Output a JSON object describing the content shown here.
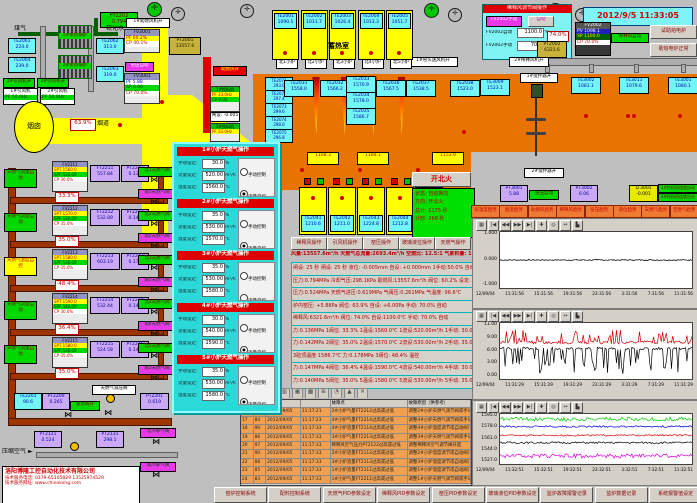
{
  "datetime": "2012/9/5 11:33:05",
  "icons": {
    "fan": "✛",
    "valve": "⋈",
    "arrow_left": "◄",
    "arrow_right": "►"
  },
  "chart_toolbar": [
    "▦",
    "|◀",
    "◀◀",
    "▶▶",
    "▶|",
    "✚",
    "◎",
    "↔",
    "▙"
  ],
  "alarm": {
    "toolbar": [
      "≣",
      "?",
      "▤",
      "▥",
      "▦",
      "▩",
      "⊞",
      "◔",
      "▲",
      "✕"
    ],
    "headers": {
      "point": "故障点",
      "cause": "故障原因（供参考）"
    },
    "rows": [
      [
        "16",
        "98",
        "2012/09/05",
        "11:17:21",
        "2#小炉气量FT2212过高或过低",
        "调整2#小炉天燃气调节阀或手动"
      ],
      [
        "17",
        "84",
        "2012/09/05",
        "11:17:23",
        "4#小炉气量FT2214过高或过低",
        "调整4#小炉天燃气调节阀或手动"
      ],
      [
        "18",
        "90",
        "2012/09/05",
        "11:17:33",
        "4#小炉流量FT2114过高或过低",
        "调整4#小炉温度调节或自动阀门"
      ],
      [
        "19",
        "86",
        "2012/09/05",
        "11:17:33",
        "3#小炉气量FT2213过高或过低",
        "调整3#小炉天燃气调节阀或手动"
      ],
      [
        "20",
        "97",
        "2012/09/05",
        "11:17:33",
        "稀释风空气压力PT2122过高或过低",
        "调整稀释风空气调节阀开度"
      ],
      [
        "21",
        "90",
        "2012/09/05",
        "11:17:33",
        "2#小炉流量FT2112过高或过低",
        "调整2#小炉温度调节或自动阀门"
      ],
      [
        "22",
        "88",
        "2012/09/05",
        "11:17:33",
        "3#小炉流量FT2113过高或过低",
        "调整3#小炉温度调节或自动阀门"
      ],
      [
        "23",
        "85",
        "2012/09/05",
        "11:17:33",
        "1#小炉流量FT2111过高或过低",
        "调整1#小炉温度调节或自动阀门"
      ],
      [
        "24",
        "83",
        "2012/09/05",
        "11:17:33",
        "1#小炉气量FT2211过高或过低",
        "调整1#小炉天燃气调节阀或手动"
      ]
    ]
  },
  "top_left": {
    "ft2202": {
      "tag": "FT2202",
      "value": "0.794"
    },
    "gas_label": "煤气",
    "water_label": "软化水",
    "boiler1": "1#余热锅炉",
    "boiler2": "2#余热锅炉",
    "te2061": {
      "tag": "TE2061",
      "value": "224.0"
    },
    "te2064": {
      "tag": "TE2064",
      "value": "239.0"
    },
    "te2062": {
      "tag": "TE2062",
      "value": "313.0"
    },
    "te2063": {
      "tag": "TE2063",
      "value": "319.0"
    },
    "fan1_on": "1#引风机开",
    "fan2_on": "2#引风机开",
    "fan1": {
      "name": "1#引风机",
      "pf": "PF 50.0Hz"
    },
    "fan2": {
      "name": "2#引风机",
      "pf": "PF 50.0Hz"
    },
    "chimney": "烟囱",
    "duct": "烟道",
    "duct_valve": "63.9%",
    "blower_on": "1#助燃风机开",
    "fv2001": {
      "tag": "FV2001",
      "pf": "PF  60.2%",
      "cp": "CP  40.1%"
    },
    "pt2001": {
      "tag": "PT2001",
      "value": "13557.6"
    },
    "kiln_auto": "窑压自动",
    "fv3001": {
      "tag": "FV3001",
      "pf": "PF  5.88",
      "sp": "SP  6.00",
      "cp": "CP 70.0%"
    },
    "comb_air_on": "助燃风开",
    "feeder1": {
      "title": "1#投料机",
      "pf": "PF 33.0Hz",
      "cp": "CP  0.00"
    },
    "feeder2": {
      "title": "2#投料机",
      "pf": "PF 33.0Hz"
    },
    "gate_set": "闸设: -0.005"
  },
  "north": {
    "fan_on": "1#窑头送风机开",
    "regen_label": "蓄热室",
    "boxes": [
      {
        "tag": "TE2001",
        "value": "1090.1"
      },
      {
        "tag": "TE2002",
        "value": "1011.7"
      },
      {
        "tag": "TE2003",
        "value": "1026.4"
      },
      {
        "tag": "TE2004",
        "value": "1013.3"
      },
      {
        "tag": "TE2005",
        "value": "1051.7"
      }
    ],
    "ports": [
      "北1小炉",
      "北2小炉",
      "北3小炉",
      "北4小炉",
      "北5小炉"
    ]
  },
  "furnace": {
    "left_col": [
      {
        "tag": "TE2071",
        "value": "293.0"
      },
      {
        "tag": "TE2072",
        "value": "297.4"
      },
      {
        "tag": "TE2073",
        "value": "299.6"
      },
      {
        "tag": "TE2074",
        "value": "298.6"
      },
      {
        "tag": "TE2075",
        "value": "296.8"
      }
    ],
    "crown": [
      {
        "tag": "TE2031",
        "value": "1558.0"
      },
      {
        "tag": "TE2032",
        "value": "1566.2"
      },
      {
        "tag": "TE2033",
        "value": "1570.9"
      },
      {
        "tag": "TE2034",
        "value": "1578.0"
      },
      {
        "tag": "TE2035",
        "value": "1586.7"
      },
      {
        "tag": "TE2036",
        "value": "1567.5"
      },
      {
        "tag": "TE2037",
        "value": "1538.5"
      },
      {
        "tag": "TE2038",
        "value": "1523.0"
      }
    ]
  },
  "south": {
    "crown": [
      "1168.3",
      "1184.1",
      "1153.9"
    ],
    "ports": [
      "南1小炉",
      "南2小炉",
      "南3小炉",
      "南4小炉",
      "南5小炉"
    ],
    "regen_label": "蓄热室",
    "boxes": [
      {
        "tag": "TE2041",
        "value": "1210.6"
      },
      {
        "tag": "TE2042",
        "value": "1211.0"
      },
      {
        "tag": "TE2043",
        "value": "1224.8"
      },
      {
        "tag": "TE2044",
        "value": "1212.8"
      },
      {
        "tag": "TE2045",
        "value": "1211.8"
      }
    ]
  },
  "status": {
    "fire_btn": "开北火",
    "rows": [
      "状态: 自动换向",
      "方向: 开北火",
      "总计: 1175 秒",
      "计时: 269 秒"
    ]
  },
  "mid_buttons": [
    "稀释风操作",
    "引风机操作",
    "窑压操作",
    "玻璃液位操作",
    "天燃气操作"
  ],
  "summary": "风量:13557.6m³/h  天燃气总流量:2693.4m³/h  空燃比: 12.5:1  气累积量: 134057.7m³",
  "data_rows": [
    "闸设: 25 秒  闸设: 25 秒  液位: -0.005mm  自设: +0.000mm  1手动:50.0% 自动 2手动:50.0% 自动",
    "压力:0.794MPa  冷却气压:298.1KPa  助燃风:13557.6m³/h 阀位: 60.2% 设定: 60.0%",
    "压力:0.524MPa  天燃气进压:0.619MPa  气阀压:0.261MPa  气温度: 96.6℃",
    "炉内窑压: +5.88Pa  阀位: 63.9%  自设: +6.00Pa  手动: 70.0%  自动",
    "稀释风:6321.6m³/h  阀位: 74.0%  自设:1100.0℃  手动: 70.0%  自动",
    "力:0.136MPa 1阀位: 33.3% 1温设:1560.0℃ 1流设:520.00m³/h 1手动: 30.0% 流控",
    "力:0.142MPa 2阀位: 35.0% 2温设:1570.0℃ 2流设:530.00m³/h 2手动: 35.0% 流控",
    "3碹顶温度:1586.7℃  力:0.178MPa 3阀位: 48.4%  温控",
    "力:0.147MPa 4阀位: 36.4% 4温设:1590.0℃ 4流设:540.00m³/h 4手动: 30.0% 流控",
    "力:0.140MPa 5阀位: 35.0% 5温设:1580.0℃ 5流设:530.00m³/h 5手动: 35.0% 流控"
  ],
  "popup": {
    "labels": {
      "manual": "手动设定:",
      "flow": "流量设定:",
      "temp": "温度设定:",
      "unit_pct": "%",
      "unit_flow": "m³/h",
      "unit_temp": "℃",
      "r0": "手动控制",
      "r1": "流量自控",
      "r2": "温度自控"
    },
    "sections": [
      {
        "title": "1#小炉天燃气操作",
        "manual": "30.0",
        "flow": "520.00",
        "temp": "1560.0",
        "d0": "",
        "d1": "●",
        "d2": ""
      },
      {
        "title": "2#小炉天燃气操作",
        "manual": "35.0",
        "flow": "530.00",
        "temp": "1570.0",
        "d0": "",
        "d1": "●",
        "d2": ""
      },
      {
        "title": "3#小炉天燃气操作",
        "manual": "35.0",
        "flow": "530.00",
        "temp": "1580.0",
        "d0": "",
        "d1": "",
        "d2": "●"
      },
      {
        "title": "4#小炉天燃气操作",
        "manual": "30.0",
        "flow": "540.00",
        "temp": "1590.0",
        "d0": "",
        "d1": "●",
        "d2": ""
      },
      {
        "title": "5#小炉天燃气操作",
        "manual": "35.0",
        "flow": "530.00",
        "temp": "1580.0",
        "d0": "",
        "d1": "●",
        "d2": ""
      }
    ]
  },
  "gas_loops": [
    {
      "auto_label": "天燃气流量自动",
      "label_variant": "green",
      "tag": "FV2211",
      "spt": "SPT 1560.0",
      "spf": "SPF 520.00",
      "cp": "CP  30.0%",
      "valve": "33.3%",
      "ft_tag": "FT2211",
      "ft": "557.84",
      "pt_tag": "PT2211",
      "pt": "0.136",
      "north": "北1天燃气阀",
      "south": "南1天燃气阀"
    },
    {
      "auto_label": "天燃气流量自动",
      "label_variant": "green",
      "tag": "FV2212",
      "spt": "SPT 1570.0",
      "spf": "SPF 530.00",
      "cp": "CP  35.0%",
      "valve": "35.0%",
      "ft_tag": "FT2212",
      "ft": "532.89",
      "pt_tag": "PT2212",
      "pt": "0.147",
      "north": "北2天燃气阀",
      "south": "南2天燃气阀"
    },
    {
      "auto_label": "天燃气温度自控",
      "label_variant": "yellow",
      "tag": "FV2213",
      "spt": "SPT 1580.0",
      "spf": "SPF 530.00",
      "cp": "CP  35.0%",
      "valve": "48.4%",
      "ft_tag": "FT2213",
      "ft": "603.19",
      "pt_tag": "PT2213",
      "pt": "0.178",
      "north": "北3天燃气阀",
      "south": "南3天燃气阀"
    },
    {
      "auto_label": "天燃气流量自动",
      "label_variant": "green",
      "tag": "FV2214",
      "spt": "SPT 1590.0",
      "spf": "SPF 540.00",
      "cp": "CP  30.0%",
      "valve": "36.4%",
      "ft_tag": "FT2214",
      "ft": "532.44",
      "pt_tag": "PT2214",
      "pt": "0.147",
      "north": "北4天燃气阀",
      "south": "南4天燃气阀"
    },
    {
      "auto_label": "天燃气流量自动",
      "label_variant": "green",
      "tag": "FV2215",
      "spt": "SPT 1580.0",
      "spf": "SPF 530.00",
      "cp": "CP  35.0%",
      "valve": "35.0%",
      "ft_tag": "FT2215",
      "ft": "524.58",
      "pt_tag": "PT2215",
      "pt": "0.140",
      "north": "北5天燃气阀",
      "south": "南5天燃气阀"
    }
  ],
  "gas_bottom": {
    "te2201": {
      "tag": "TE2201",
      "value": "90.6"
    },
    "pt2200": {
      "tag": "PT2200",
      "value": "0.265"
    },
    "emergency": "紧急阀开",
    "reducer": "天燃气减压阀",
    "pt2201": {
      "tag": "PT2201",
      "value": "0.619"
    }
  },
  "air": {
    "label": "压缩空气",
    "pt2121": {
      "tag": "PT2121",
      "value": "0.524"
    },
    "pt2131": {
      "tag": "PT2131",
      "value": "298.1"
    },
    "north": "北冷却气阀",
    "south": "南冷却气阀"
  },
  "company": {
    "name": "洛阳博隆工控自动化技术有限公司",
    "tel": "技术服务电话: 0379-65105829  13525974529",
    "web": "技术服务网址: www.chinakong.com"
  },
  "dilution": {
    "title": "稀释风调节阀操作",
    "btn_manual": "FV2002手动",
    "btn_auto": "自动",
    "auto_label": "FV2002自动",
    "auto_value": "1100.0",
    "auto_unit": "℃",
    "manual_label": "FV2002手动",
    "manual_value": "70.0",
    "manual_unit": "%",
    "fv2002": {
      "tag": "FV2002",
      "pv": "PV 1098.1",
      "sp": "SP 1100.0",
      "cp": "CP  70.0%"
    },
    "auto_tag": "稀释风自动",
    "valve": "74.0%",
    "pt2002": {
      "tag": "PT2002",
      "value": "6321.6"
    },
    "fan_on": "2#稀释风机开",
    "stirrer1_on": "1#搅拌器开",
    "stirrer2_on": "2#搅拌器开",
    "btn_test": "试助熔电炉",
    "btn_normal": "助熔电炉正常"
  },
  "working_end": {
    "te3009": {
      "tag": "TE3009",
      "value": "1523.1"
    },
    "te3002": {
      "tag": "TE3002",
      "value": "1081.1"
    },
    "te3011": {
      "tag": "TE3011",
      "value": "1079.6"
    },
    "te3001": {
      "tag": "TE3001",
      "value": "1080.1"
    }
  },
  "right_status": {
    "pt3001": {
      "tag": "PT3001",
      "value": "5.88"
    },
    "kiln_auto": "窑压自动",
    "pt3002": {
      "tag": "PT3002",
      "value": "6.06"
    },
    "lt3001": {
      "tag": "LT3001",
      "value": "-0.001"
    },
    "feeder1_auto": "1#投料机连锁自动",
    "feeder2_auto": "2#投料机连锁自动"
  },
  "trend_buttons": [
    "窑温度趋势",
    "烟温趋势",
    "助燃风趋势",
    "稀释风趋势",
    "窑压趋势",
    "液位趋势",
    "天燃气趋势",
    "空燃气趋势"
  ],
  "bottom_buttons": [
    "窑炉控制系统",
    "配料控制系统",
    "天燃气PID参数设定",
    "稀释风PID参数设定",
    "窑压PID参数设定",
    "玻璃液位PID参数设定",
    "监炉故障报警记录",
    "监炉数据记录",
    "系统报警值设定"
  ],
  "chart_data": [
    {
      "type": "line",
      "date": "12/09/04",
      "xticks": [
        "11:31:56",
        "15:31:56",
        "19:31:56",
        "23:31:56",
        "3:31:56",
        "7:31:56",
        "11:31:56"
      ],
      "yticks": [
        "1.000",
        "0.000",
        "-1.000"
      ],
      "ylim": [
        -1,
        1
      ],
      "midline": true,
      "series": [
        {
          "name": "kiln-pressure",
          "color": "#000000",
          "level": 0,
          "noise": 0.02
        }
      ]
    },
    {
      "type": "line",
      "date": "12/09/04",
      "xticks": [
        "11:31:29",
        "15:31:29",
        "19:31:29",
        "23:31:29",
        "3:31:29",
        "7:31:29",
        "11:31:29"
      ],
      "yticks": [
        "11.00",
        "9.00",
        "6.00",
        "3.00",
        "0.00"
      ],
      "ylim": [
        0,
        11
      ],
      "series": [
        {
          "name": "series-red",
          "color": "#CC0000",
          "level": 7.2,
          "noise": 0.3,
          "spike_p": 0.22,
          "spike": 2.6,
          "dir": 1
        },
        {
          "name": "series-black",
          "color": "#000000",
          "level": 6.0,
          "noise": 0.25,
          "spike_p": 0.3,
          "spike": 5.0,
          "dir": -1
        }
      ]
    },
    {
      "type": "line",
      "date": "12/09/04",
      "xticks": [
        "11:32:51",
        "15:32:51",
        "19:32:51",
        "23:32:51",
        "3:32:51",
        "7:32:51",
        "11:32:51"
      ],
      "yticks": [
        "1595.0",
        "1578.0",
        "1561.0",
        "1544.0",
        "1527.0"
      ],
      "ylim": [
        1527,
        1595
      ],
      "series": [
        {
          "name": "series-green",
          "color": "#00CC00",
          "level": 1587,
          "noise": 1.5,
          "spike_p": 0.3,
          "spike": 4,
          "dir": 1
        },
        {
          "name": "series-blue",
          "color": "#0000DD",
          "level": 1578,
          "noise": 1.2
        },
        {
          "name": "series-red",
          "color": "#DD0000",
          "level": 1566,
          "noise": 1.0
        },
        {
          "name": "series-black",
          "color": "#000000",
          "level": 1556,
          "noise": 1.3
        },
        {
          "name": "series-magenta",
          "color": "#DD00DD",
          "level": 1539,
          "noise": 1.8,
          "spike_p": 0.25,
          "spike": 4,
          "dir": -1
        }
      ]
    }
  ]
}
